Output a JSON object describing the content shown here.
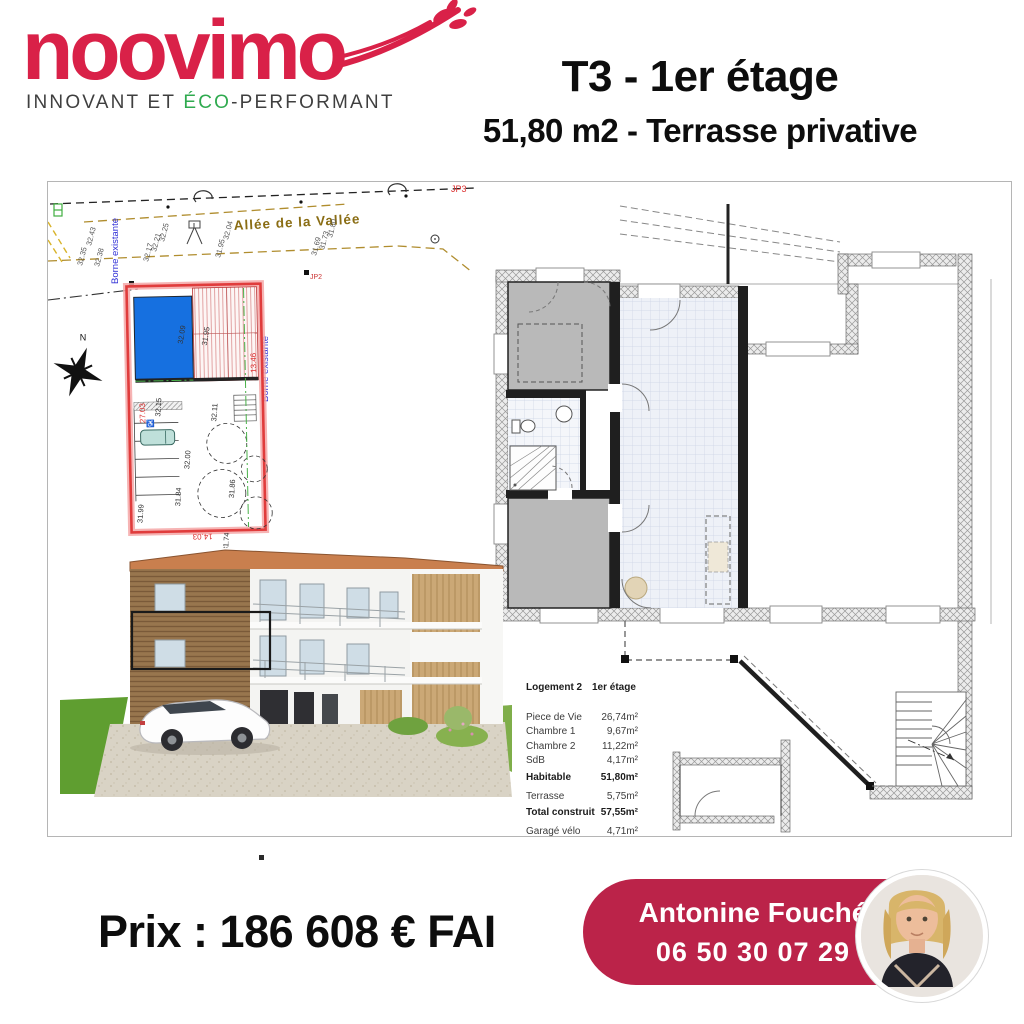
{
  "brand": {
    "wordmark": "noovimo",
    "tagline_pre": "INNOVANT ET ",
    "tagline_eco": "ÉCO",
    "tagline_post": "-PERFORMANT",
    "logo_color": "#d92148",
    "eco_color": "#2faa4f"
  },
  "header": {
    "title": "T3 - 1er étage",
    "subtitle": "51,80 m2 - Terrasse privative"
  },
  "site_plan": {
    "street_name": "Allée de la Vallée",
    "borne_label": "Borne existante",
    "marker_jp3": "JP3",
    "marker_jp2": "JP2",
    "north_label": "N",
    "road_elevations": [
      "32.35",
      "32.43",
      "32.38",
      "32.17",
      "32.21",
      "32.25",
      "31.95",
      "32.04",
      "31.69",
      "31.73",
      "31.80"
    ],
    "parcel_elevations": [
      "32.09",
      "31.95",
      "32.15",
      "32.11",
      "32.00",
      "31.84",
      "31.99",
      "31.86",
      "31.74"
    ],
    "red_dimensions": [
      "27.03",
      "13.46",
      "14.03"
    ],
    "parcel_color": "#e03c3c",
    "building_color": "#1670e0"
  },
  "area_table": {
    "header_left": "Logement 2",
    "header_right": "1er étage",
    "rows": [
      {
        "label": "Piece de Vie",
        "value": "26,74m²"
      },
      {
        "label": "Chambre 1",
        "value": "9,67m²"
      },
      {
        "label": "Chambre 2",
        "value": "11,22m²"
      },
      {
        "label": "SdB",
        "value": "4,17m²"
      },
      {
        "label": "Habitable",
        "value": "51,80m²"
      },
      {
        "label": "Terrasse",
        "value": "5,75m²"
      },
      {
        "label": "Total construit",
        "value": "57,55m²"
      },
      {
        "label": "Garagé vélo",
        "value": "4,71m²"
      }
    ]
  },
  "footer": {
    "price": "Prix : 186 608 € FAI"
  },
  "contact": {
    "name": "Antonine Fouché",
    "phone": "06 50 30 07 29",
    "pill_color": "#bb2349"
  }
}
